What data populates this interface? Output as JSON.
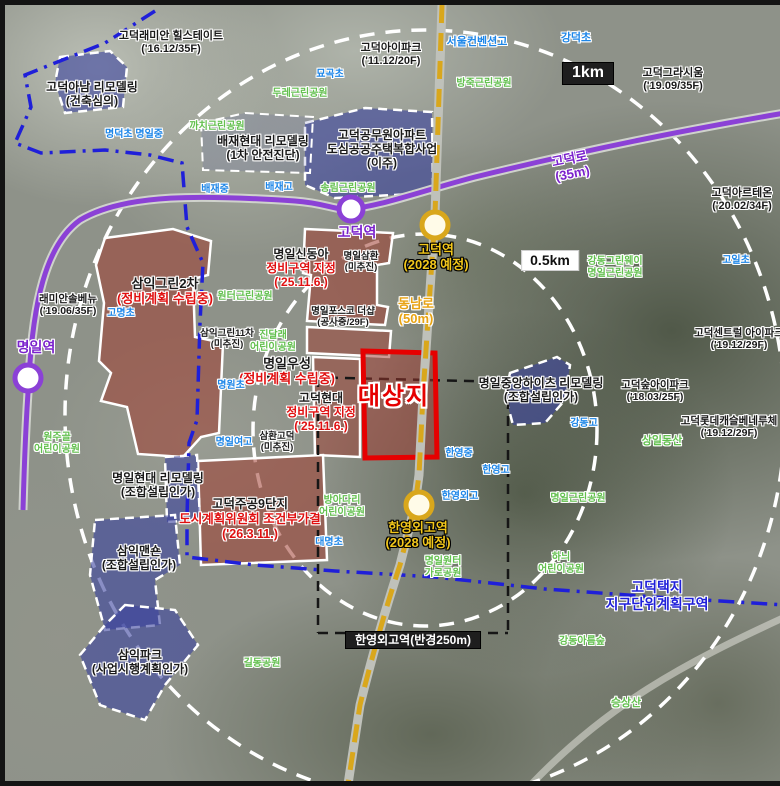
{
  "map": {
    "colors": {
      "subway_line5_purple": "#8b41d6",
      "planned_road_yellow": "#d9a71c",
      "target_site_red": "#e60000",
      "redevelopment_zone_fill": "rgba(158,60,48,0.55)",
      "remodeling_zone_fill": "rgba(58,66,158,0.6)",
      "school_text_blue": "#1d86e8",
      "park_text_green": "#63c04f",
      "district_boundary_blue": "#1f1fd9",
      "status_text_red": "#e01010"
    },
    "labels": [
      {
        "id": "label-godeok-raemian-hillstate",
        "x": 166,
        "y": 25,
        "fs": 11,
        "lines": [
          {
            "t": "고덕래미안 힐스테이트",
            "c": "k"
          },
          {
            "t": "('16.12/35F)",
            "c": "k"
          }
        ]
      },
      {
        "id": "label-godeok-anam-remodeling",
        "x": 87,
        "y": 75,
        "fs": 12,
        "lines": [
          {
            "t": "고덕아남 리모델링",
            "c": "k"
          },
          {
            "t": "(건축심의)",
            "c": "k"
          }
        ]
      },
      {
        "id": "label-godeok-ipark",
        "x": 386,
        "y": 37,
        "fs": 11,
        "lines": [
          {
            "t": "고덕아이파크",
            "c": "k"
          },
          {
            "t": "('11.12/20F)",
            "c": "k"
          }
        ]
      },
      {
        "id": "label-seoul-convention-high",
        "x": 472,
        "y": 31,
        "fs": 11,
        "lines": [
          {
            "t": "서울컨벤션고",
            "c": "b"
          }
        ]
      },
      {
        "id": "label-gangdeok-elementary",
        "x": 571,
        "y": 27,
        "fs": 11,
        "lines": [
          {
            "t": "강덕초",
            "c": "b"
          }
        ]
      },
      {
        "id": "label-godeok-gracium",
        "x": 668,
        "y": 62,
        "fs": 11,
        "lines": [
          {
            "t": "고덕그라시움",
            "c": "k"
          },
          {
            "t": "('19.09/35F)",
            "c": "k"
          }
        ]
      },
      {
        "id": "label-myogok-elementary",
        "x": 325,
        "y": 64,
        "fs": 10,
        "lines": [
          {
            "t": "묘곡초",
            "c": "b"
          }
        ]
      },
      {
        "id": "label-dure-park",
        "x": 295,
        "y": 83,
        "fs": 10,
        "lines": [
          {
            "t": "두레근린공원",
            "c": "g"
          }
        ]
      },
      {
        "id": "label-bangjuk-park",
        "x": 479,
        "y": 73,
        "fs": 10,
        "lines": [
          {
            "t": "방죽근린공원",
            "c": "g"
          }
        ]
      },
      {
        "id": "label-myeongdeok-myeongil-school",
        "x": 129,
        "y": 124,
        "fs": 10,
        "lines": [
          {
            "t": "명덕초  명일중",
            "c": "b"
          }
        ]
      },
      {
        "id": "label-kkachi-park",
        "x": 212,
        "y": 116,
        "fs": 10,
        "lines": [
          {
            "t": "까치근린공원",
            "c": "g"
          }
        ]
      },
      {
        "id": "label-baejae-hyundai-remodeling",
        "x": 258,
        "y": 129,
        "fs": 12,
        "lines": [
          {
            "t": "배재현대 리모델링",
            "c": "k"
          },
          {
            "t": "(1차 안전진단)",
            "c": "k"
          }
        ]
      },
      {
        "id": "label-godeok-official-apt",
        "x": 377,
        "y": 123,
        "fs": 12,
        "lines": [
          {
            "t": "고덕공무원아파트",
            "c": "k"
          },
          {
            "t": "도심공공주택복합사업",
            "c": "k"
          },
          {
            "t": "(이주)",
            "c": "k"
          }
        ]
      },
      {
        "id": "label-baejae-middle",
        "x": 210,
        "y": 179,
        "fs": 10,
        "lines": [
          {
            "t": "배재중",
            "c": "b"
          }
        ]
      },
      {
        "id": "label-baejae-high",
        "x": 274,
        "y": 177,
        "fs": 10,
        "lines": [
          {
            "t": "배재고",
            "c": "b"
          }
        ]
      },
      {
        "id": "label-songnim-park",
        "x": 343,
        "y": 178,
        "fs": 10,
        "lines": [
          {
            "t": "송림근린공원",
            "c": "g"
          }
        ]
      },
      {
        "id": "label-godeok-ro",
        "x": 566,
        "y": 146,
        "fs": 13,
        "rot": -11,
        "lines": [
          {
            "t": "고덕로",
            "c": "p"
          },
          {
            "t": "(35m)",
            "c": "p"
          }
        ]
      },
      {
        "id": "label-godeok-arteon",
        "x": 737,
        "y": 182,
        "fs": 11,
        "lines": [
          {
            "t": "고덕아르테온",
            "c": "k"
          },
          {
            "t": "('20.02/34F)",
            "c": "k"
          }
        ]
      },
      {
        "id": "label-godeok-station",
        "x": 352,
        "y": 219,
        "fs": 14,
        "lines": [
          {
            "t": "고덕역",
            "c": "p"
          }
        ]
      },
      {
        "id": "label-godeok-station-2028",
        "x": 431,
        "y": 237,
        "fs": 13,
        "lines": [
          {
            "t": "고덕역",
            "c": "y"
          },
          {
            "t": "(2028 예정)",
            "c": "y"
          }
        ]
      },
      {
        "id": "label-myeongil-samhwan",
        "x": 356,
        "y": 246,
        "fs": 9.5,
        "lines": [
          {
            "t": "명일삼환",
            "c": "k"
          },
          {
            "t": "(미추진)",
            "c": "k"
          }
        ]
      },
      {
        "id": "label-gangdong-greenway-park",
        "x": 610,
        "y": 251,
        "fs": 10,
        "lines": [
          {
            "t": "강동그린웨이",
            "c": "g"
          },
          {
            "t": "명일근린공원",
            "c": "g"
          }
        ]
      },
      {
        "id": "label-goil-elementary",
        "x": 731,
        "y": 250,
        "fs": 10,
        "lines": [
          {
            "t": "고일초",
            "c": "b"
          }
        ]
      },
      {
        "id": "label-raemian-solbenyu",
        "x": 63,
        "y": 288,
        "fs": 10.5,
        "lines": [
          {
            "t": "래미안솔베뉴",
            "c": "k"
          },
          {
            "t": "('19.06/35F)",
            "c": "k"
          }
        ]
      },
      {
        "id": "label-gomyeong-elementary",
        "x": 116,
        "y": 303,
        "fs": 10,
        "lines": [
          {
            "t": "고명초",
            "c": "b"
          }
        ]
      },
      {
        "id": "label-samik-green2",
        "x": 160,
        "y": 271,
        "fs": 13,
        "lines": [
          {
            "t": "삼익그린2차",
            "c": "k"
          },
          {
            "t": "(정비계획 수립중)",
            "c": "r"
          }
        ]
      },
      {
        "id": "label-myeongil-sindonga",
        "x": 296,
        "y": 242,
        "fs": 12,
        "lines": [
          {
            "t": "명일신동아",
            "c": "k"
          },
          {
            "t": "정비구역 지정",
            "c": "r"
          },
          {
            "t": "('25.11.6.)",
            "c": "r"
          }
        ]
      },
      {
        "id": "label-wonteo-park",
        "x": 240,
        "y": 286,
        "fs": 10,
        "lines": [
          {
            "t": "원터근린공원",
            "c": "g"
          }
        ]
      },
      {
        "id": "label-myeongil-posco",
        "x": 338,
        "y": 301,
        "fs": 9.5,
        "lines": [
          {
            "t": "명일포스코 더샵",
            "c": "k"
          },
          {
            "t": "(공사중/29F)",
            "c": "k"
          }
        ]
      },
      {
        "id": "label-dongnam-ro",
        "x": 411,
        "y": 291,
        "fs": 13,
        "lines": [
          {
            "t": "동남로",
            "c": "o"
          },
          {
            "t": "(50m)",
            "c": "o"
          }
        ]
      },
      {
        "id": "label-samik-green11",
        "x": 222,
        "y": 323,
        "fs": 9.5,
        "lines": [
          {
            "t": "삼익그린11차",
            "c": "k"
          },
          {
            "t": "(미추진)",
            "c": "k"
          }
        ]
      },
      {
        "id": "label-jindallae-park",
        "x": 268,
        "y": 325,
        "fs": 10,
        "lines": [
          {
            "t": "진달래",
            "c": "g"
          },
          {
            "t": "어린이공원",
            "c": "g"
          }
        ]
      },
      {
        "id": "label-myeongil-wooseong",
        "x": 282,
        "y": 351,
        "fs": 13,
        "lines": [
          {
            "t": "명일우성",
            "c": "k"
          },
          {
            "t": "(정비계획 수립중)",
            "c": "r"
          }
        ]
      },
      {
        "id": "label-myeongwon-elementary",
        "x": 226,
        "y": 375,
        "fs": 10,
        "lines": [
          {
            "t": "명원초",
            "c": "b"
          }
        ]
      },
      {
        "id": "label-godeok-hyundai",
        "x": 316,
        "y": 386,
        "fs": 12,
        "lines": [
          {
            "t": "고덕현대",
            "c": "k"
          },
          {
            "t": "정비구역 지정",
            "c": "r"
          },
          {
            "t": "('25.11.6.)",
            "c": "r"
          }
        ]
      },
      {
        "id": "label-daesangji",
        "x": 389,
        "y": 378,
        "fs": 24,
        "lines": [
          {
            "t": "대상지",
            "c": "s"
          }
        ]
      },
      {
        "id": "label-myeongil-jungang-heights",
        "x": 536,
        "y": 371,
        "fs": 12,
        "lines": [
          {
            "t": "명일중앙하이츠 리모델링",
            "c": "k"
          },
          {
            "t": "(조합설립인가)",
            "c": "k"
          }
        ]
      },
      {
        "id": "label-godeok-soop-ipark",
        "x": 650,
        "y": 374,
        "fs": 10.5,
        "lines": [
          {
            "t": "고덕숲아이파크",
            "c": "k"
          },
          {
            "t": "('18.03/25F)",
            "c": "k"
          }
        ]
      },
      {
        "id": "label-godeok-central-ipark",
        "x": 734,
        "y": 322,
        "fs": 10.5,
        "lines": [
          {
            "t": "고덕센트럴 아이파크",
            "c": "k"
          },
          {
            "t": "('19.12/29F)",
            "c": "k"
          }
        ]
      },
      {
        "id": "label-godeok-lotte-castle",
        "x": 724,
        "y": 410,
        "fs": 10.5,
        "lines": [
          {
            "t": "고덕롯데캐슬베네루체",
            "c": "k"
          },
          {
            "t": "('19.12/29F)",
            "c": "k"
          }
        ]
      },
      {
        "id": "label-sangil-dongsan",
        "x": 657,
        "y": 430,
        "fs": 11,
        "lines": [
          {
            "t": "상일동산",
            "c": "g"
          }
        ]
      },
      {
        "id": "label-gangdong-high",
        "x": 579,
        "y": 413,
        "fs": 10,
        "lines": [
          {
            "t": "강동고",
            "c": "b"
          }
        ]
      },
      {
        "id": "label-myeongil-girls-high",
        "x": 229,
        "y": 432,
        "fs": 10,
        "lines": [
          {
            "t": "명일여고",
            "c": "b"
          }
        ]
      },
      {
        "id": "label-samhwan-godeok",
        "x": 272,
        "y": 426,
        "fs": 9.5,
        "lines": [
          {
            "t": "삼환고덕",
            "c": "k"
          },
          {
            "t": "(미추진)",
            "c": "k"
          }
        ]
      },
      {
        "id": "label-wonjugol-park",
        "x": 52,
        "y": 427,
        "fs": 10,
        "lines": [
          {
            "t": "원주골",
            "c": "g"
          },
          {
            "t": "어린이공원",
            "c": "g"
          }
        ]
      },
      {
        "id": "label-myeongil-station",
        "x": 31,
        "y": 334,
        "fs": 14,
        "lines": [
          {
            "t": "명일역",
            "c": "p"
          }
        ]
      },
      {
        "id": "label-hanyeong-middle",
        "x": 454,
        "y": 443,
        "fs": 10,
        "lines": [
          {
            "t": "한영중",
            "c": "b"
          }
        ]
      },
      {
        "id": "label-hanyeong-high",
        "x": 491,
        "y": 460,
        "fs": 10,
        "lines": [
          {
            "t": "한영고",
            "c": "b"
          }
        ]
      },
      {
        "id": "label-hanyeong-foreign-high",
        "x": 455,
        "y": 486,
        "fs": 10,
        "lines": [
          {
            "t": "한영외고",
            "c": "b"
          }
        ]
      },
      {
        "id": "label-myeongil-park",
        "x": 573,
        "y": 488,
        "fs": 10,
        "lines": [
          {
            "t": "명일근린공원",
            "c": "g"
          }
        ]
      },
      {
        "id": "label-myeongil-hyundai-remodeling",
        "x": 153,
        "y": 466,
        "fs": 12,
        "lines": [
          {
            "t": "명일현대 리모델링",
            "c": "k"
          },
          {
            "t": "(조합설립인가)",
            "c": "k"
          }
        ]
      },
      {
        "id": "label-godeok-jugong9",
        "x": 245,
        "y": 492,
        "fs": 12.5,
        "lines": [
          {
            "t": "고덕주공9단지",
            "c": "k"
          },
          {
            "t": "도시계획위원회 조건부가결",
            "c": "r"
          },
          {
            "t": "('26.3.11.)",
            "c": "r"
          }
        ]
      },
      {
        "id": "label-samik-mansion",
        "x": 134,
        "y": 539,
        "fs": 12,
        "lines": [
          {
            "t": "삼익맨숀",
            "c": "k"
          },
          {
            "t": "(조합설립인가)",
            "c": "k"
          }
        ]
      },
      {
        "id": "label-bangadari-park",
        "x": 337,
        "y": 490,
        "fs": 10,
        "lines": [
          {
            "t": "방아다리",
            "c": "g"
          },
          {
            "t": "어린이공원",
            "c": "g"
          }
        ]
      },
      {
        "id": "label-daemyeong-elementary",
        "x": 324,
        "y": 532,
        "fs": 10,
        "lines": [
          {
            "t": "대명초",
            "c": "b"
          }
        ]
      },
      {
        "id": "label-hanyeong-station-2028",
        "x": 413,
        "y": 515,
        "fs": 13,
        "lines": [
          {
            "t": "한영외고역",
            "c": "y"
          },
          {
            "t": "(2028 예정)",
            "c": "y"
          }
        ]
      },
      {
        "id": "label-myeongil-wonteo-park",
        "x": 438,
        "y": 551,
        "fs": 10,
        "lines": [
          {
            "t": "명일원터",
            "c": "g"
          },
          {
            "t": "가로공원",
            "c": "g"
          }
        ]
      },
      {
        "id": "label-hanui-park",
        "x": 556,
        "y": 547,
        "fs": 10,
        "lines": [
          {
            "t": "하늬",
            "c": "g"
          },
          {
            "t": "어린이공원",
            "c": "g"
          }
        ]
      },
      {
        "id": "label-godeok-taekji-district",
        "x": 652,
        "y": 574,
        "fs": 14,
        "lines": [
          {
            "t": "고덕택지",
            "c": "d"
          },
          {
            "t": "지구단위계획구역",
            "c": "d"
          }
        ]
      },
      {
        "id": "label-gangdong-areumsoop",
        "x": 577,
        "y": 631,
        "fs": 10,
        "lines": [
          {
            "t": "강동아름숲",
            "c": "g"
          }
        ]
      },
      {
        "id": "label-gildong-park",
        "x": 257,
        "y": 653,
        "fs": 10,
        "lines": [
          {
            "t": "길동공원",
            "c": "g"
          }
        ]
      },
      {
        "id": "label-seungsangsan",
        "x": 621,
        "y": 692,
        "fs": 11,
        "lines": [
          {
            "t": "승상산",
            "c": "g"
          }
        ]
      },
      {
        "id": "label-samik-park",
        "x": 135,
        "y": 643,
        "fs": 12,
        "lines": [
          {
            "t": "삼익파크",
            "c": "k"
          },
          {
            "t": "(사업시행계획인가)",
            "c": "k"
          }
        ]
      },
      {
        "id": "scale-1km",
        "x": 583,
        "y": 57,
        "fs": 16,
        "type": "box-dark",
        "lines": [
          {
            "t": "1km",
            "c": "w"
          }
        ]
      },
      {
        "id": "scale-05km",
        "x": 545,
        "y": 245,
        "fs": 14,
        "type": "box-light",
        "lines": [
          {
            "t": "0.5km",
            "c": "k2"
          }
        ]
      },
      {
        "id": "label-hanyeong-station-radius",
        "x": 408,
        "y": 626,
        "fs": 12,
        "type": "box-dark",
        "lines": [
          {
            "t": "한영외고역(반경250m)",
            "c": "w"
          }
        ]
      }
    ]
  }
}
